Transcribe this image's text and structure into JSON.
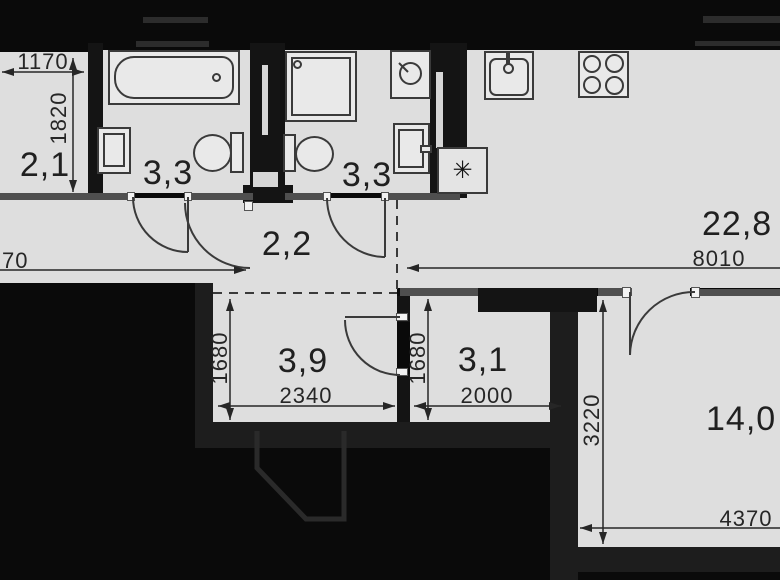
{
  "plan_areas": {
    "storage": "2,1",
    "bath1": "3,3",
    "bath2": "3,3",
    "hall": "2,2",
    "kitchen_living": "22,8",
    "inner_hall": "3,9",
    "wardrobe": "3,1",
    "bedroom": "14,0"
  },
  "plan_dims": {
    "storage_width": "1170",
    "storage_depth": "1820",
    "corridor": "70",
    "kitchen_width": "8010",
    "inner_hall_depth": "1680",
    "inner_hall_width": "2340",
    "wardrobe_depth": "1680",
    "wardrobe_width": "2000",
    "bedroom_depth": "3220",
    "bedroom_width": "4370"
  },
  "symbols": {
    "vent": "✳"
  },
  "colors": {
    "floor": "#dedede",
    "wall_dark": "#141414",
    "wall_gray": "#4f4f4f",
    "line": "#3a3a3a",
    "background": "#0a0a0a"
  }
}
